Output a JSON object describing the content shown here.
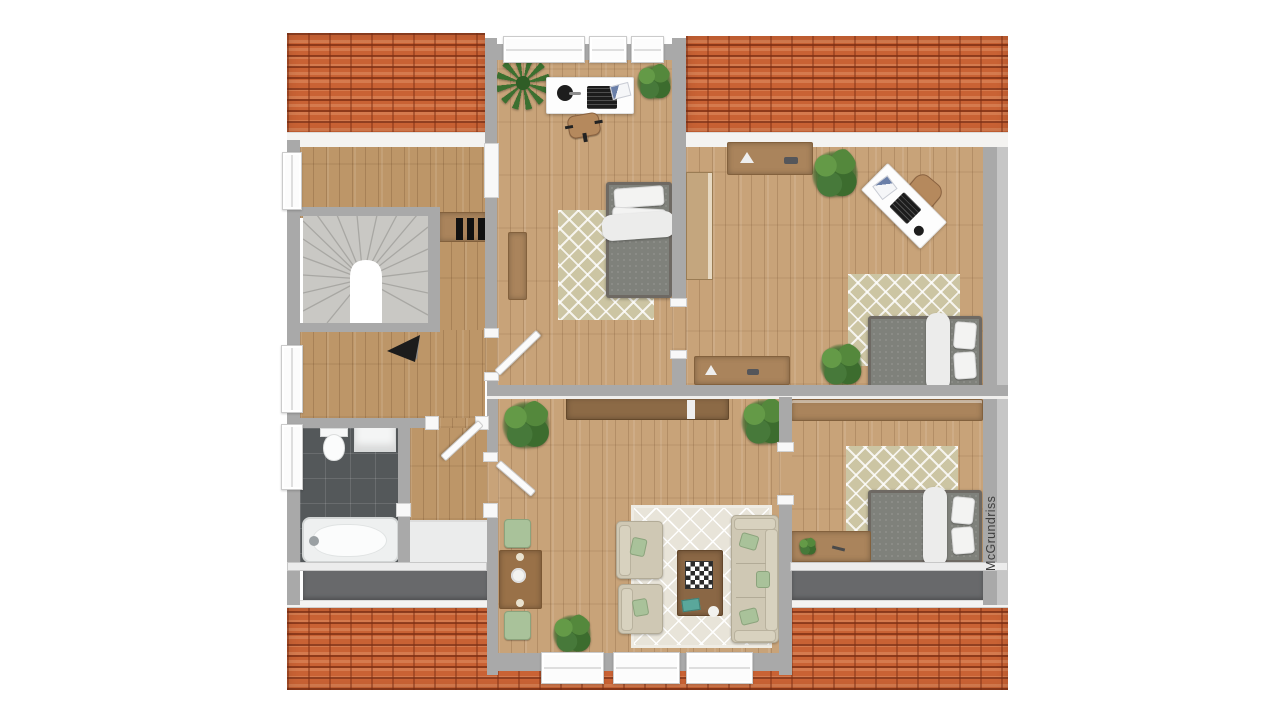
{
  "watermark": {
    "text": "McGrundriss"
  },
  "palette": {
    "background": "#ffffff",
    "roof": "#c96234",
    "roof_shadow": "#7a2c12",
    "eaves": "#f4f3f1",
    "wall": "#a9a9a9",
    "wall_outer": "#c6c6c6",
    "wood_floor": "#c8a379",
    "wood_floor_hall": "#bd9668",
    "bath_tile": "#54585a",
    "balcony": "#68696b",
    "stairs": "#c9c8c4",
    "storage_floor": "#ebecec",
    "rug_beige": "#ccc5a3",
    "rug_light": "#e8e4d9",
    "furniture_wood": "#aa845c",
    "sideboard_dark": "#8c6a46",
    "bed_frame": "#6e6963",
    "mattress_grey": "#7f817b",
    "textile_white": "#f3f3f2",
    "sofa_beige": "#cfc8b4",
    "cushion_green": "#a9c29a",
    "plant_green": "#3f7432",
    "desk_white": "#fdfdfd",
    "arrow_black": "#1c1c1c",
    "radiator_black": "#111111"
  },
  "structure": {
    "rooms": [
      "landing",
      "stairwell",
      "hallway",
      "office-room",
      "bedroom-east",
      "bedroom-southeast",
      "living-room",
      "bathroom",
      "storage-room",
      "balcony-west",
      "balcony-east"
    ],
    "window_count": {
      "top_wall": 3,
      "left_wall": 3,
      "bottom_wall": 3
    },
    "door_leaf_count": 3,
    "stair_type": "winder-u-turn"
  }
}
